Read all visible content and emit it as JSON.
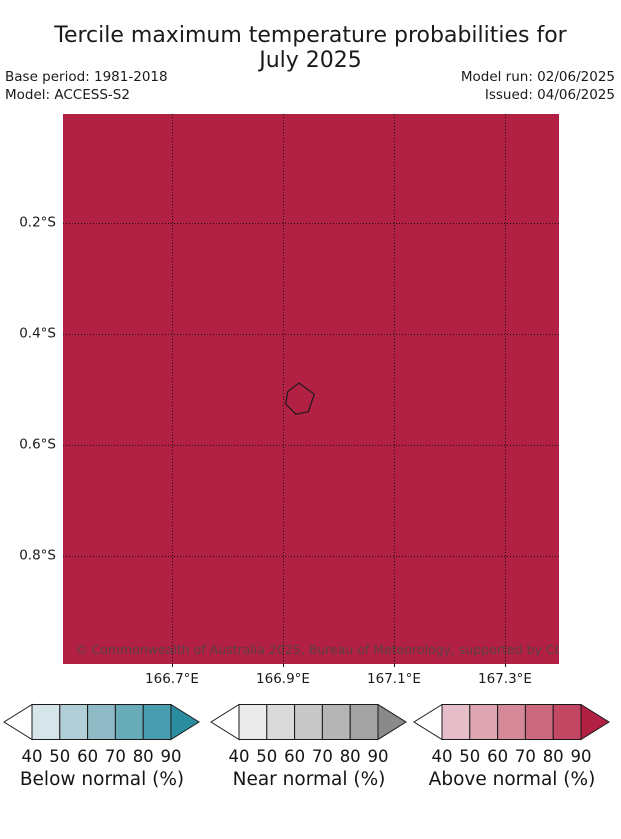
{
  "title": {
    "line1": "Tercile maximum temperature probabilities for",
    "line2": "July 2025"
  },
  "header": {
    "base_period": "Base period: 1981-2018",
    "model": "Model: ACCESS-S2",
    "model_run": "Model run: 02/06/2025",
    "issued": "Issued: 04/06/2025"
  },
  "map": {
    "fill_color": "#b22044",
    "coastline_color": "#1a1a1a",
    "attribution": "© Commonwealth of Australia 2025, Bureau of Meteorology, supported by COSPPac",
    "x_ticks": [
      "166.7°E",
      "166.9°E",
      "167.1°E",
      "167.3°E"
    ],
    "y_ticks": [
      "0.2°S",
      "0.4°S",
      "0.6°S",
      "0.8°S"
    ]
  },
  "colorbars": [
    {
      "label": "Below normal (%)",
      "ticks": [
        "40",
        "50",
        "60",
        "70",
        "80",
        "90"
      ],
      "colors": [
        "#d6e5ea",
        "#b2cfd8",
        "#8fb9c4",
        "#68abb9",
        "#479dae"
      ],
      "arrow_left_color": "#ffffff",
      "arrow_right_color": "#2b8c9f"
    },
    {
      "label": "Near normal (%)",
      "ticks": [
        "40",
        "50",
        "60",
        "70",
        "80",
        "90"
      ],
      "colors": [
        "#ebebeb",
        "#dadada",
        "#c8c8c8",
        "#b5b5b5",
        "#a3a3a3"
      ],
      "arrow_left_color": "#ffffff",
      "arrow_right_color": "#8a8a8a"
    },
    {
      "label": "Above normal (%)",
      "ticks": [
        "40",
        "50",
        "60",
        "70",
        "80",
        "90"
      ],
      "colors": [
        "#e6bec9",
        "#dea5b2",
        "#d58898",
        "#cb6a7f",
        "#c14763"
      ],
      "arrow_left_color": "#ffffff",
      "arrow_right_color": "#b22044"
    }
  ],
  "chart_data": {
    "type": "map",
    "title": "Tercile maximum temperature probabilities for July 2025",
    "model": "ACCESS-S2",
    "base_period": "1981-2018",
    "model_run_date": "02/06/2025",
    "issued_date": "04/06/2025",
    "lon_ticks_deg_E": [
      166.7,
      166.9,
      167.1,
      167.3
    ],
    "lat_ticks_deg_S": [
      0.2,
      0.4,
      0.6,
      0.8
    ],
    "legend_bins_percent": [
      40,
      50,
      60,
      70,
      80,
      90
    ],
    "legend_categories": [
      "Below normal (%)",
      "Near normal (%)",
      "Above normal (%)"
    ],
    "depicted": "Entire map domain shaded in the darkest 'Above normal' class (probability above 90%); small island coastline outlined near 0.52S 166.93E"
  }
}
